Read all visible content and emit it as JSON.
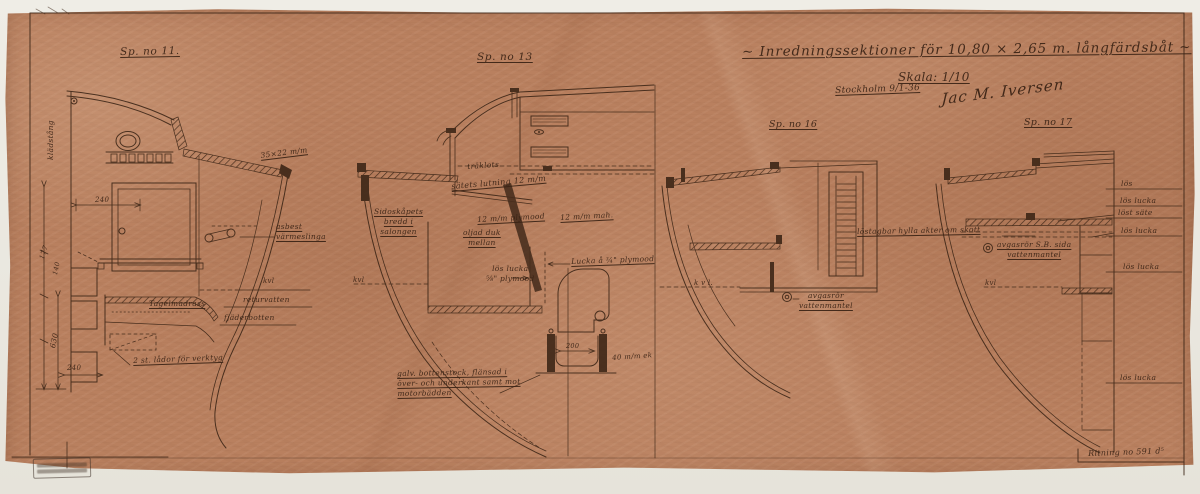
{
  "palette": {
    "paper": "#b9805f",
    "ink": "#3a2415",
    "scan_background": "#e9e6de"
  },
  "title_block": {
    "title": "~ Inredningssektioner för 10,80 × 2,65 m. långfärdsbåt ~",
    "scale": "Skala: 1/10",
    "place_date": "Stockholm 9/1-36",
    "signature": "Jac M. Iversen"
  },
  "drawing_number": "Ritning no 591 d⁵",
  "sections": [
    {
      "label": "Sp. no 11.",
      "annotations": {
        "kladstang": "klädstång",
        "dim_240_top": "240",
        "dim_35x22": "35×22 m/m",
        "asbest": "asbest\nvärmeslinga",
        "kvl": "kvl",
        "returvatten": "returvatten",
        "fjaderbotten": "fjäderbotten",
        "tagelmadrass": "Tagelmadrass",
        "lador": "2 st. lådor för verktyg",
        "dim_177": "177",
        "dim_140": "140",
        "dim_630": "630",
        "dim_240_bottom": "240"
      }
    },
    {
      "label": "Sp. no 13",
      "annotations": {
        "traklots": "träklots",
        "satets_lutning": "sätets lutning 12 m/m",
        "plymood": "12 m/m plymood",
        "mah": "12 m/m mah.",
        "oljad_duk": "oljad duk\nmellan",
        "sidoskapets": "Sidoskåpets\nbredd i\nsalongen",
        "kvl": "kvl",
        "los_lucka": "lös lucka\n⅝\" plymood",
        "lucka_34": "Lucka å ¾\" plymood",
        "dim_200": "200",
        "ek_40": "40 m/m ek",
        "bottenstock": "galv. bottenstock, flänsad i\növer- och underkant samt mot\nmotorbädden"
      }
    },
    {
      "label": "Sp. no 16",
      "annotations": {
        "kvl": "k v l.",
        "avgasror": "avgasrör\nvattenmantel"
      }
    },
    {
      "label": "Sp. no 17",
      "annotations": {
        "hylla": "löstagbar hylla akter om skott",
        "avgasror": "avgasrör S.B. sida\nvattenmantel",
        "kvl": "kvl",
        "los": "lös",
        "los_lucka_1": "lös lucka",
        "lost_sate": "löst säte",
        "los_lucka_2": "lös lucka",
        "los_lucka_3": "lös lucka",
        "los_lucka_4": "lös lucka"
      }
    }
  ]
}
